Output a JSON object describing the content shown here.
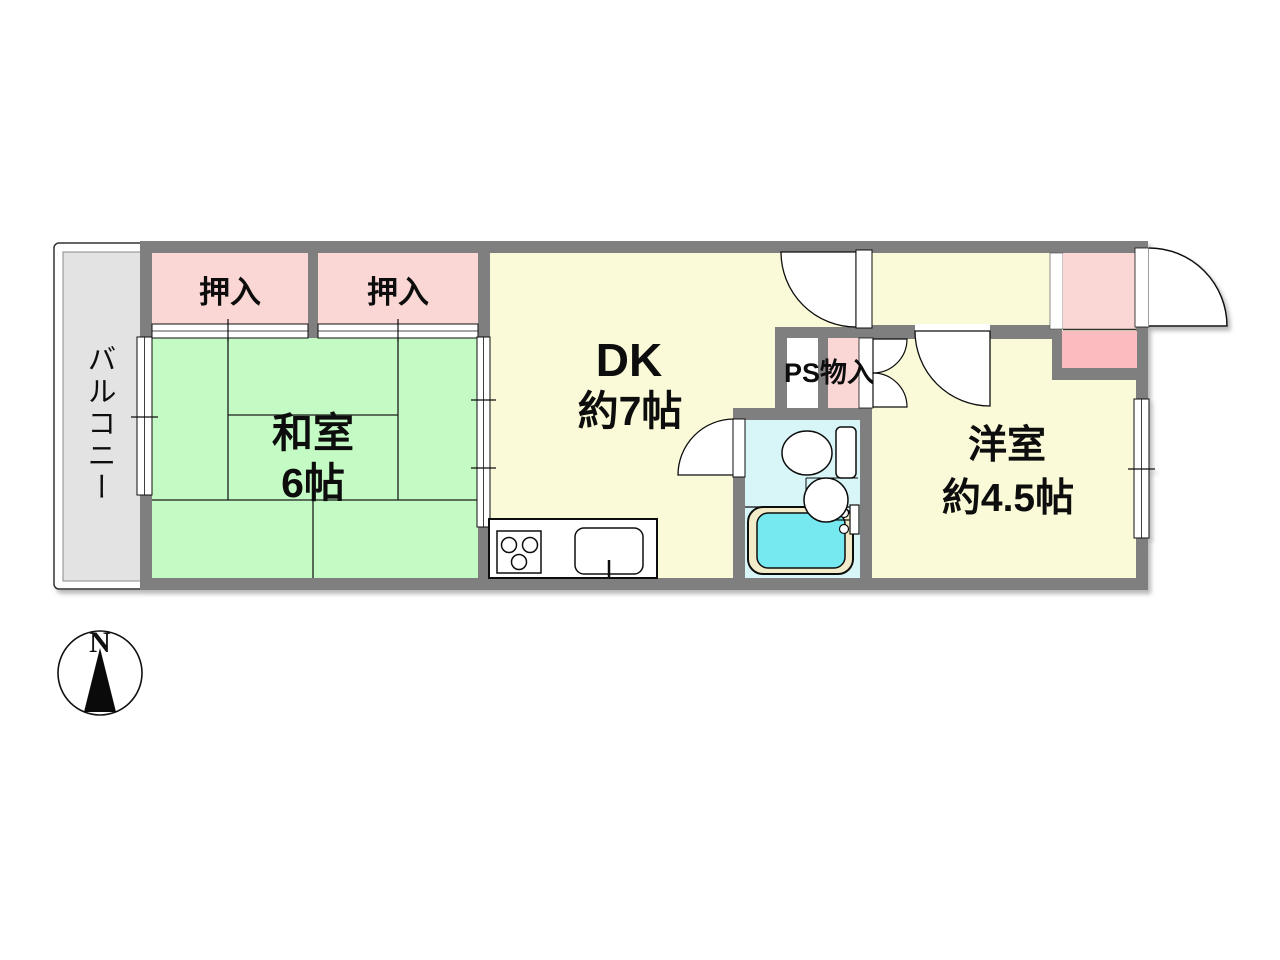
{
  "plan": {
    "type": "apartment-floor-plan",
    "rooms": {
      "balcony": {
        "label": "バルコニー"
      },
      "closet_left": {
        "label": "押入"
      },
      "closet_right": {
        "label": "押入"
      },
      "washitsu": {
        "name": "和室",
        "size": "6帖"
      },
      "dk": {
        "name": "DK",
        "size": "約7帖"
      },
      "ps_closet": {
        "label": "PS物入"
      },
      "yoshitsu": {
        "name": "洋室",
        "size": "約4.5帖"
      }
    },
    "compass": {
      "north_label": "N"
    }
  },
  "colors": {
    "wall": "#7f7f7f",
    "washitsu_green": "#c4fbc4",
    "room_yellow": "#fafad8",
    "closet_pink": "#fad7d4",
    "closet_pink_dark": "#fbbcc0",
    "bath_cyan": "#d8f5f7",
    "bath_water": "#76e8ef",
    "tub_rim": "#f1ebc9",
    "balcony_gray": "#e3e3e3"
  }
}
